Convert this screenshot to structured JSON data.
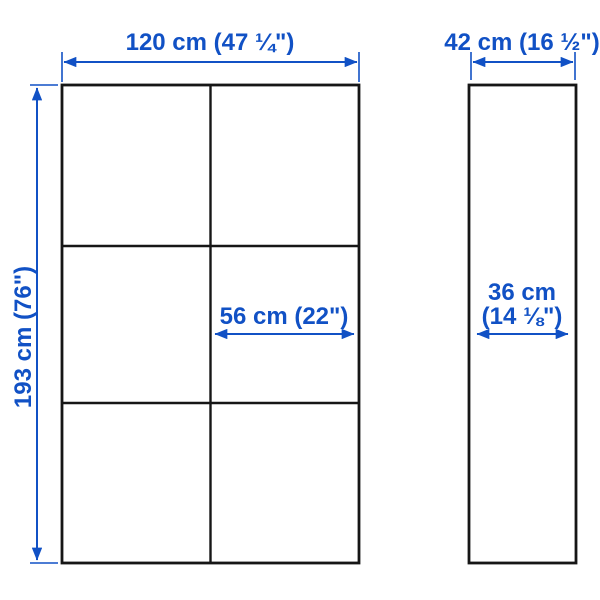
{
  "colors": {
    "accent": "#1151c5",
    "outline": "#161616",
    "background": "#ffffff"
  },
  "diagram": {
    "front_view_grid": {
      "columns": 2,
      "rows": 3
    },
    "labels": {
      "overall_width": "120 cm (47 ¼\")",
      "overall_depth": "42 cm (16 ½\")",
      "overall_height": "193 cm (76\")",
      "section_width": "56 cm (22\")",
      "inner_depth_line1": "36 cm",
      "inner_depth_line2": "(14 ⅛\")"
    }
  }
}
